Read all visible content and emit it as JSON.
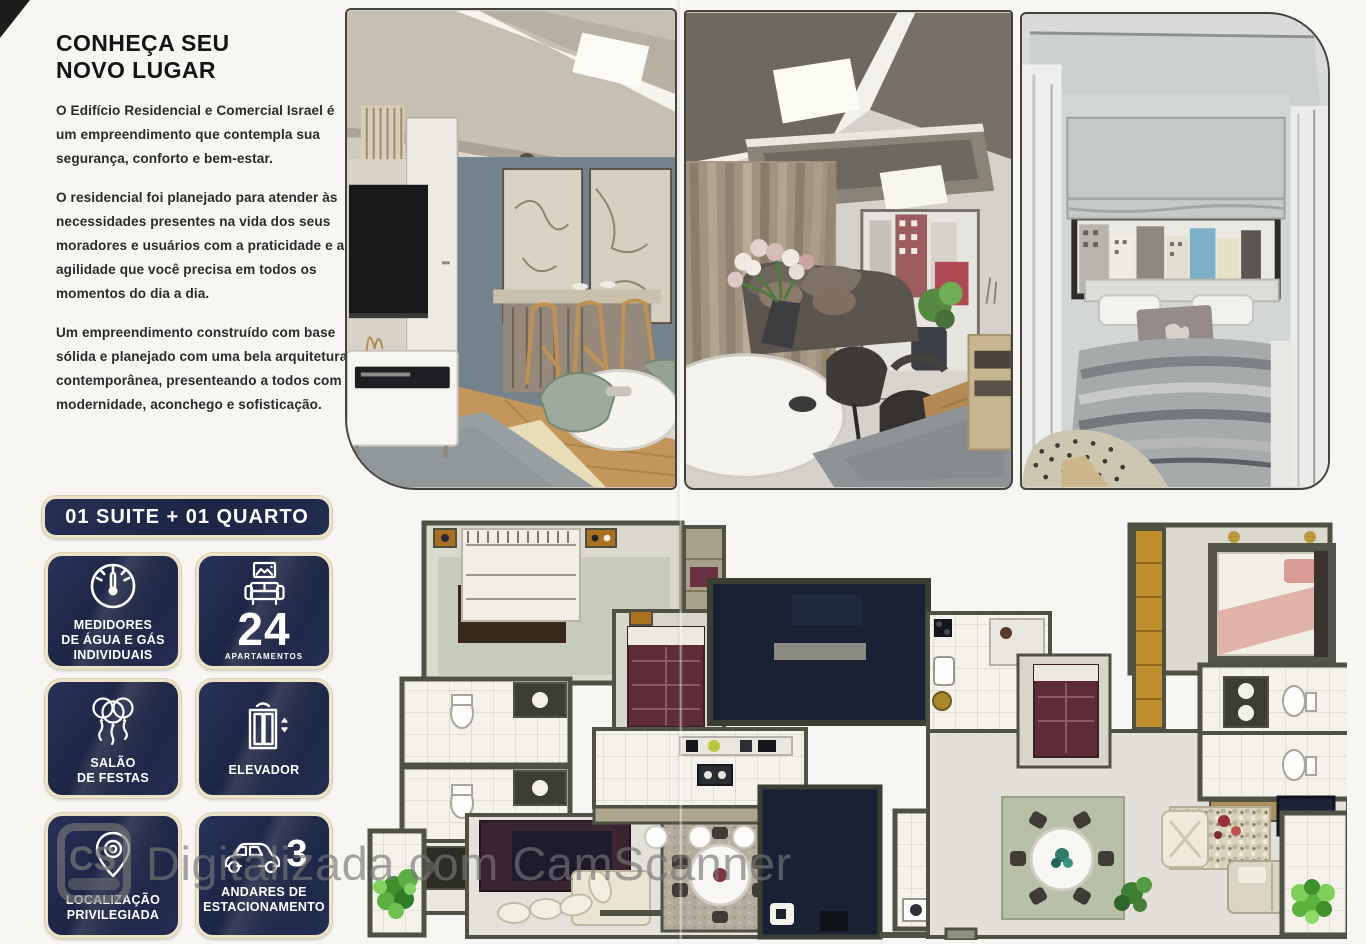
{
  "intro": {
    "title": "CONHEÇA SEU\nNOVO LUGAR",
    "paragraphs": [
      "O Edifício Residencial e Comercial Israel é um empreendimento que contempla sua segurança, conforto e bem-estar.",
      "O residencial foi planejado para atender às necessidades presentes na vida dos seus moradores e usuários com a praticidade e a agilidade que você precisa em todos os momentos do dia a dia.",
      "Um empreendimento construído com base sólida e planejado com uma bela arquitetura contemporânea, presenteando a todos com modernidade, aconchego e sofisticação."
    ]
  },
  "unit_badge": {
    "label": "01 SUITE + 01 QUARTO"
  },
  "features": [
    {
      "id": "meters",
      "icon": "water-gas-meter-icon",
      "label": "MEDIDORES\nDE ÁGUA E GÁS\nINDIVIDUAIS"
    },
    {
      "id": "apartments",
      "icon": "sofa-frame-icon",
      "number": "24",
      "label": "APARTAMENTOS"
    },
    {
      "id": "party-hall",
      "icon": "balloons-icon",
      "label": "SALÃO\nDE FESTAS"
    },
    {
      "id": "elevator",
      "icon": "elevator-icon",
      "label": "ELEVADOR"
    },
    {
      "id": "location",
      "icon": "location-pin-icon",
      "label": "LOCALIZAÇÃO\nPRIVILEGIADA"
    },
    {
      "id": "parking",
      "icon": "car-icon",
      "number": "3",
      "label": "ANDARES DE\nESTACIONAMENTO"
    }
  ],
  "watermark": {
    "logo_text": "CS",
    "text": "Digitalizada com CamScanner"
  },
  "colors": {
    "badge_navy": "#1d2545",
    "badge_border": "#ece2c6",
    "plan_navy": "#1a2136",
    "plan_wall": "#4f5243",
    "watermark_gray": "#767676",
    "paper": "#f7f6f2"
  }
}
